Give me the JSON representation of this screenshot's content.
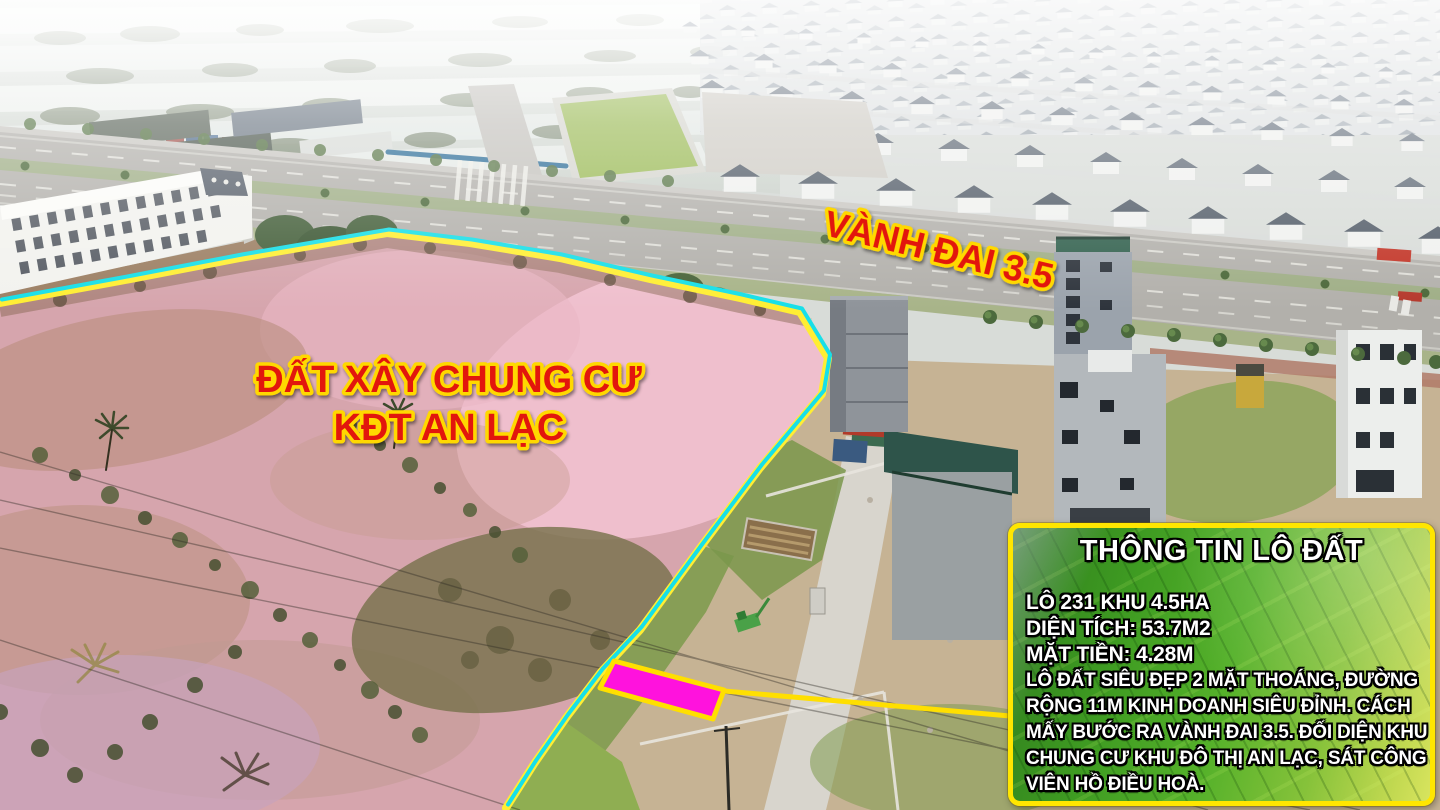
{
  "annotations": {
    "area_label_line1": "ĐẤT XÂY CHUNG CƯ",
    "area_label_line2": "KĐT AN LẠC",
    "road_label": "VÀNH ĐAI 3.5"
  },
  "info_box": {
    "title": "THÔNG TIN LÔ ĐẤT",
    "lines": [
      "LÔ 231 KHU 4.5HA",
      "DIỆN TÍCH: 53.7M2",
      "MẶT TIỀN: 4.28M",
      "LÔ ĐẤT SIÊU ĐẸP 2 MẶT THOÁNG, ĐƯỜNG",
      "RỘNG 11M KINH DOANH SIÊU ĐỈNH. CÁCH",
      "MẤY BƯỚC RA VÀNH ĐAI 3.5. ĐỐI DIỆN KHU",
      "CHUNG CƯ KHU ĐÔ THỊ AN LẠC, SÁT CÔNG",
      "VIÊN HỒ ĐIỀU HOÀ."
    ]
  },
  "colors": {
    "highlight_pink": "#e3aec1",
    "boundary_cyan": "#17dfe8",
    "boundary_yellow": "#ffee33",
    "plot_magenta": "#ff12dd",
    "connector_yellow": "#ffdf00",
    "label_red": "#e2180c",
    "label_outline_yellow": "#ffd800",
    "box_border_yellow": "#ffe600",
    "box_green": "#46a31f",
    "info_text_white": "#ffffff"
  }
}
